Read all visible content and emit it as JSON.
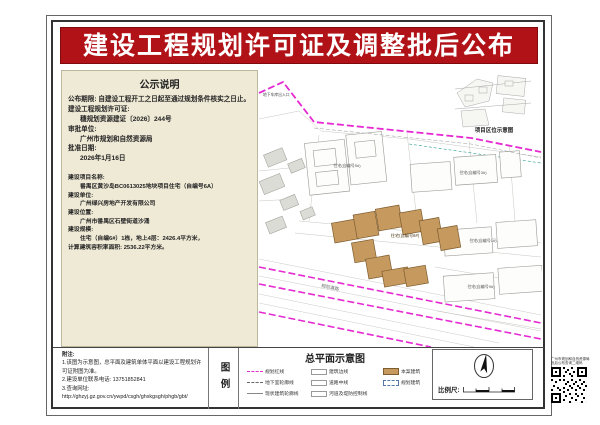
{
  "colors": {
    "banner_red": "#b01217",
    "boundary_magenta": "#e52ad2",
    "building_tan": "#c6995f",
    "panel_cream": "#efead6"
  },
  "banner": {
    "title": "建设工程规划许可证及调整批后公布"
  },
  "notice": {
    "title": "公示说明",
    "period_label": "公布期限:",
    "period_value": "自建设工程开工之日起至通过规划条件核实之日止。",
    "permit_label": "建设工程规划许可证:",
    "permit_value": "穗规划资源建证〔2026〕244号",
    "authority_label": "审批单位:",
    "authority_value": "广州市规划和自然资源局",
    "date_label": "批准日期:",
    "date_value": "2026年1月16日"
  },
  "project": {
    "name_label": "建设项目名称:",
    "name_value": "番禺区黄沙岛BC0613025地块项目住宅（自编号6A）",
    "builder_label": "建设单位:",
    "builder_value": "广州绿兴房地产开发有限公司",
    "location_label": "建设位置:",
    "location_value": "广州市番禺区石壁街道沙涌",
    "scope_label": "建设规模:",
    "scope_value": "住宅（自编6#）1栋，地上4层：2426.4平方米，",
    "far_line": "计算建筑容积率面积: 2536.22平方米。"
  },
  "map": {
    "inset_caption": "项目区位示意图",
    "plan_title": "总平面示意图",
    "road_label": "规划道路",
    "entrance_label": "地下车库出入口",
    "bldg_main": "住宅(自编号6#)",
    "bldg_a": "住宅(自编号5#)",
    "bldg_b": "住宅(自编号3#)",
    "bldg_right": "住宅(自编号1#)",
    "bldg_lower": "住宅(自编号9#)"
  },
  "legend": {
    "box_label": "图例",
    "items": [
      {
        "label": "规划红线"
      },
      {
        "label": "地下室轮廓线"
      },
      {
        "label": "现状建筑轮廓线"
      },
      {
        "label": "建筑边线"
      },
      {
        "label": "道路中线"
      },
      {
        "label": "河道及堤防控制线"
      },
      {
        "label": "本案建筑"
      },
      {
        "label": "规划建筑"
      }
    ]
  },
  "scale": {
    "label": "比例尺:"
  },
  "notes": {
    "title": "附注:",
    "line1": "1.该图为示意图，总平面及建筑单体平面以建设工程规划许可证附图为准。",
    "line2": "2.建设单位联系电话: 13751852841",
    "line3": "3.查询网址:",
    "url": "http://ghzyj.gz.gov.cn/ywpd/csgh/ghxkgsgh/phgb/gbt/"
  },
  "qr": {
    "caption1": "广州市规划和自然资源局",
    "caption2": "批后公布查询二维码"
  }
}
